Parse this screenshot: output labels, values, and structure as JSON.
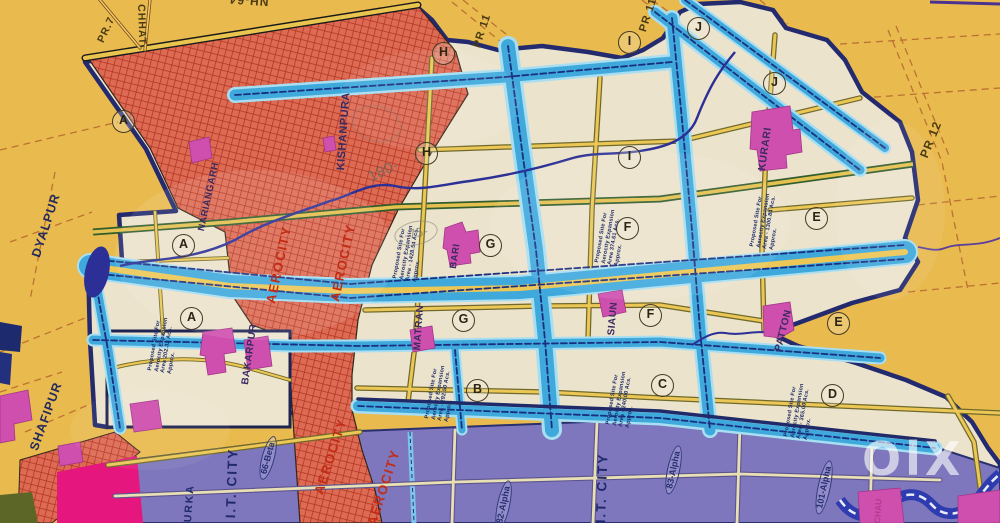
{
  "watermark": {
    "logo_text": "OlX"
  },
  "map": {
    "road_labels": {
      "pr7": "PR.7",
      "chhat": "CHHAT",
      "nh64": "NH-64",
      "pr11_a": "PR 11",
      "pr11_b": "PR 11",
      "pr12": "PR 12"
    },
    "place_labels": {
      "dyalpur": "DYALPUR",
      "shafipur": "SHAFIPUR",
      "nariangarh": "NARIANGARH",
      "kishanpura": "KISHANPURA",
      "matran": "MATRAN",
      "siaun": "SIAUN",
      "bari": "BARI",
      "kurari": "KURARI",
      "patton": "PATTON",
      "bakarpur": "BAKARPUR",
      "urka": "URKA",
      "chau": "CHAU"
    },
    "zone_labels": {
      "aerocity": "AEROCITY",
      "it_city": "I.T. CITY",
      "beta_66": "66-Beta",
      "alpha_82": "82-Alpha",
      "alpha_83": "83-Alpha",
      "alpha_101": "101-Alpha"
    },
    "sector_markers": {
      "a": "A",
      "b": "B",
      "c": "C",
      "d": "D",
      "e": "E",
      "f": "F",
      "g": "G",
      "h": "H",
      "i": "I",
      "j": "J"
    },
    "proposed_sites": {
      "common": {
        "line1": "Proposed Site For",
        "line2": "Aerocity Expansion",
        "line4": "Approx."
      },
      "areas": {
        "a": "Area 202.32 Acs.",
        "g": "Area - 1428.54 Acs.",
        "f": "Area 374.61 Acs.",
        "e": "Area - 1300.84 Acs.",
        "b": "Area - 292.50 Acs.",
        "c": "Area - 240.00 Acs.",
        "d": "Area - 365.00 Acs."
      }
    },
    "handwriting": {
      "note_a": "180-",
      "note_b": "-75-"
    },
    "colors": {
      "background_yellow": "#e9ba4e",
      "plan_cream": "#ece3cc",
      "aerocity_red": "#dd6b54",
      "road_cyan": "#3fa9dc",
      "it_city_purple": "#7e77bd",
      "village_magenta": "#cf4fae",
      "boundary_navy": "#232a6e",
      "highlight_pink": "#e5177e"
    }
  }
}
